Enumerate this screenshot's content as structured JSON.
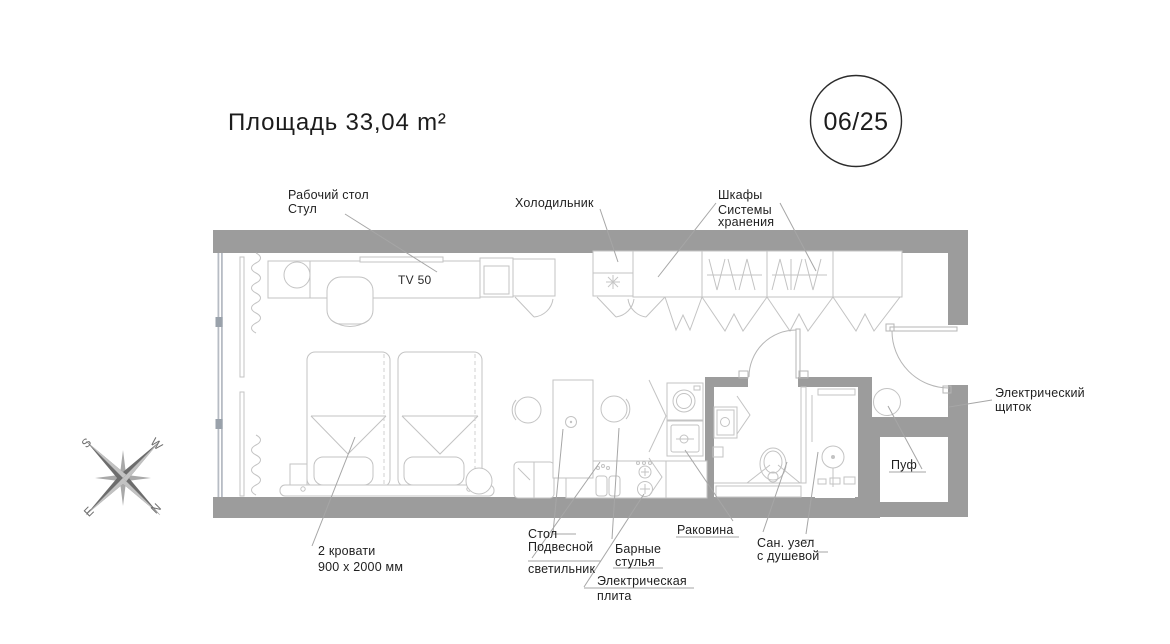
{
  "title": "Площадь 33,04 m²",
  "badge": "06/25",
  "colors": {
    "wall": "#9c9c9c",
    "north": "#e25565",
    "glazing": "#b7bcc4"
  },
  "labels": {
    "desk1": "Рабочий стол",
    "desk2": "Стул",
    "fridge": "Холодильник",
    "closets1": "Шкафы",
    "closets2": "Системы",
    "closets3": "хранения",
    "tv": "TV 50",
    "panel1": "Электрический",
    "panel2": "щиток",
    "pouf": "Пуф",
    "beds1": "2 кровати",
    "beds2": "900 x 2000 мм",
    "table1": "Стол",
    "table2": "Подвесной",
    "table3": "светильник",
    "stools1": "Барные",
    "stools2": "стулья",
    "stove1": "Электрическая",
    "stove2": "плита",
    "sink": "Раковина",
    "wc1": "Сан. узел",
    "wc2": "с душевой"
  },
  "compass": {
    "n": "N",
    "w": "W",
    "s": "S",
    "e": "E"
  }
}
